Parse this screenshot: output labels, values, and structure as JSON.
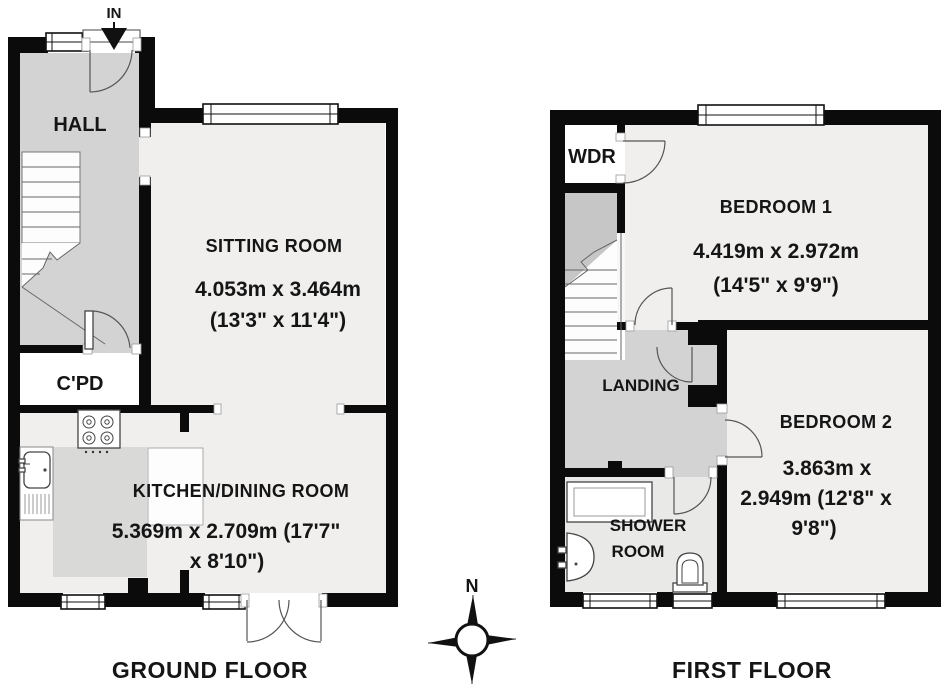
{
  "colors": {
    "wall": "#0b0b0b",
    "corridor": "#d3d3d3",
    "corridor_dark": "#c6c6c6",
    "room": "#f0efee",
    "shower_room": "#e9e9e8",
    "counter": "#d9d9d8",
    "background": "#ffffff"
  },
  "compass": {
    "north_label": "N"
  },
  "ground_floor": {
    "title": "GROUND FLOOR",
    "entrance_label": "IN",
    "rooms": {
      "hall": {
        "name": "HALL"
      },
      "cupboard": {
        "name": "C'PD"
      },
      "sitting_room": {
        "name": "SITTING ROOM",
        "dimensions_metric": "4.053m x 3.464m",
        "dimensions_imperial": "(13'3\" x 11'4\")"
      },
      "kitchen_dining": {
        "name": "KITCHEN/DINING ROOM",
        "dimensions_line1": "5.369m x 2.709m (17'7\"",
        "dimensions_line2": "x 8'10\")"
      }
    }
  },
  "first_floor": {
    "title": "FIRST FLOOR",
    "rooms": {
      "wardrobe": {
        "name": "WDR"
      },
      "bedroom1": {
        "name": "BEDROOM 1",
        "dimensions_metric": "4.419m x 2.972m",
        "dimensions_imperial": "(14'5\" x 9'9\")"
      },
      "bedroom2": {
        "name": "BEDROOM 2",
        "dimensions_line1": "3.863m x",
        "dimensions_line2": "2.949m (12'8\" x",
        "dimensions_line3": "9'8\")"
      },
      "landing": {
        "name": "LANDING"
      },
      "shower_room": {
        "name_line1": "SHOWER",
        "name_line2": "ROOM"
      }
    }
  }
}
